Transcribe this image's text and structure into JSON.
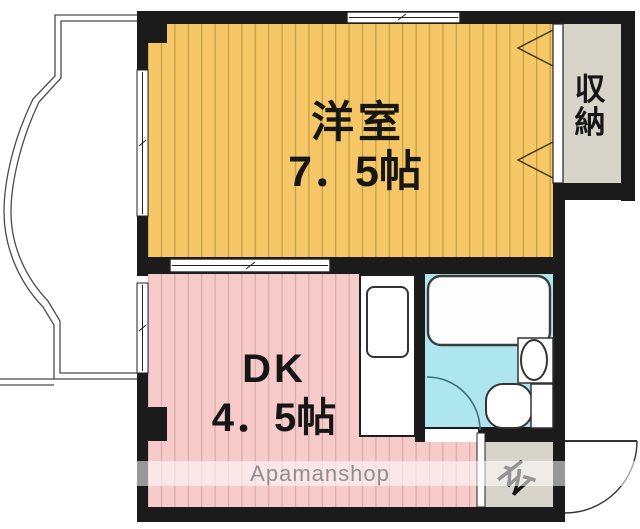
{
  "floorplan": {
    "rooms": {
      "western_room": {
        "name": "洋室",
        "size": "7．5帖"
      },
      "dk": {
        "name": "DK",
        "size": "4．5帖"
      },
      "closet": {
        "label": "収納",
        "chars": [
          "収",
          "納"
        ]
      },
      "entrance": {
        "label": "玄"
      }
    },
    "watermark": {
      "text": "Apamanshop"
    },
    "colors": {
      "western_room_floor": "#f5c766",
      "western_room_stripe": "#a8872f",
      "dk_floor": "#f7cbca",
      "dk_stripe": "#d2a2a2",
      "bathroom_floor": "#aee6f0",
      "closet_floor": "#d7d4ca",
      "entrance_floor": "#d7d4ca",
      "wall": "#1b1b1b",
      "watermark_band": "rgba(255,255,255,0.55)"
    }
  }
}
